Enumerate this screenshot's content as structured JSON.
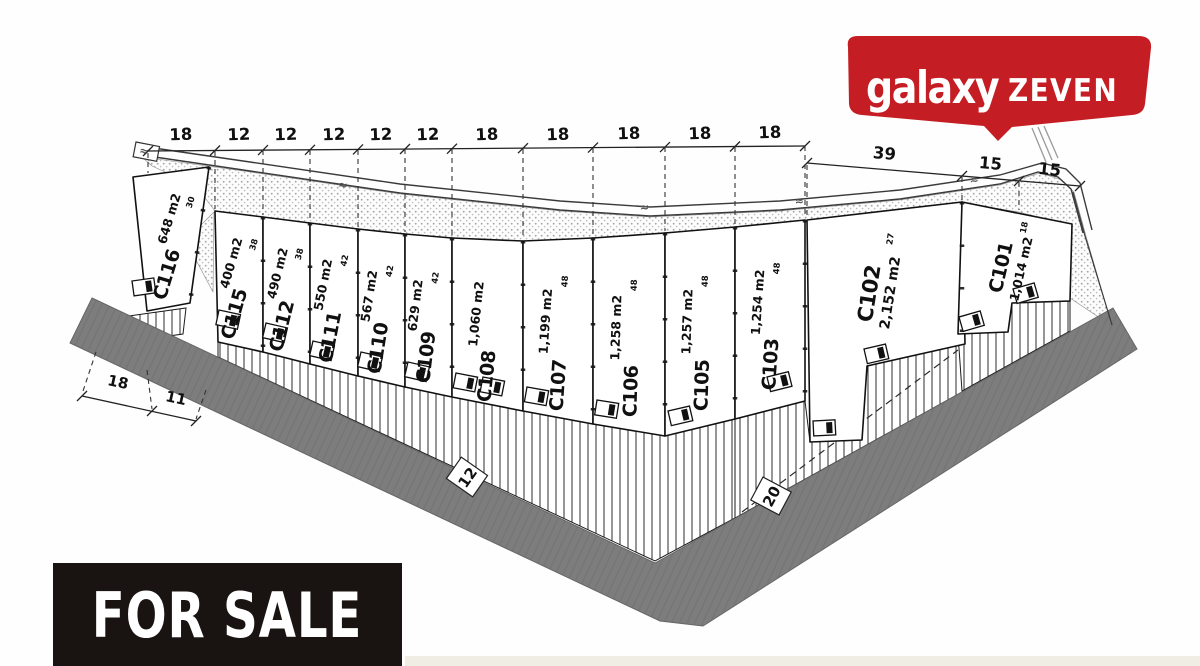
{
  "logo": {
    "word1": "galaxy",
    "word2": "ZEVEN",
    "banner_color": "#c41e24",
    "text_color": "#ffffff"
  },
  "for_sale": {
    "label": "FOR SALE",
    "bg": "#191412",
    "fg": "#ffffff"
  },
  "site_plan": {
    "squiggle": "≈",
    "top_dims": [
      "18",
      "12",
      "12",
      "12",
      "12",
      "12",
      "18",
      "18",
      "18",
      "18",
      "18"
    ],
    "right_dims": [
      "39",
      "15",
      "15"
    ],
    "bottom_dims": [
      "18",
      "11"
    ],
    "road_width_markers": [
      "12",
      "20"
    ],
    "colors": {
      "road_band": "#7d7d7d",
      "stipple_dot": "#a8a8a8",
      "plot_fill": "#ffffff",
      "line": "#1a1a1a"
    },
    "plots": [
      {
        "id": "C116",
        "area": "648 m2",
        "side": "30"
      },
      {
        "id": "C115",
        "area": "400 m2",
        "side": "38"
      },
      {
        "id": "C112",
        "area": "490 m2",
        "side": "38"
      },
      {
        "id": "C111",
        "area": "550 m2",
        "side": "42"
      },
      {
        "id": "C110",
        "area": "567 m2",
        "side": "42"
      },
      {
        "id": "C109",
        "area": "629 m2",
        "side": "42"
      },
      {
        "id": "C108",
        "area": "1,060 m2",
        "side": ""
      },
      {
        "id": "C107",
        "area": "1,199 m2",
        "side": "48"
      },
      {
        "id": "C106",
        "area": "1,258 m2",
        "side": "48"
      },
      {
        "id": "C105",
        "area": "1,257 m2",
        "side": "48"
      },
      {
        "id": "C103",
        "area": "1,254 m2",
        "side": "48"
      },
      {
        "id": "C102",
        "area": "2,152 m2",
        "side": "27"
      },
      {
        "id": "C101",
        "area": "1,014 m2",
        "side": "18"
      }
    ]
  }
}
